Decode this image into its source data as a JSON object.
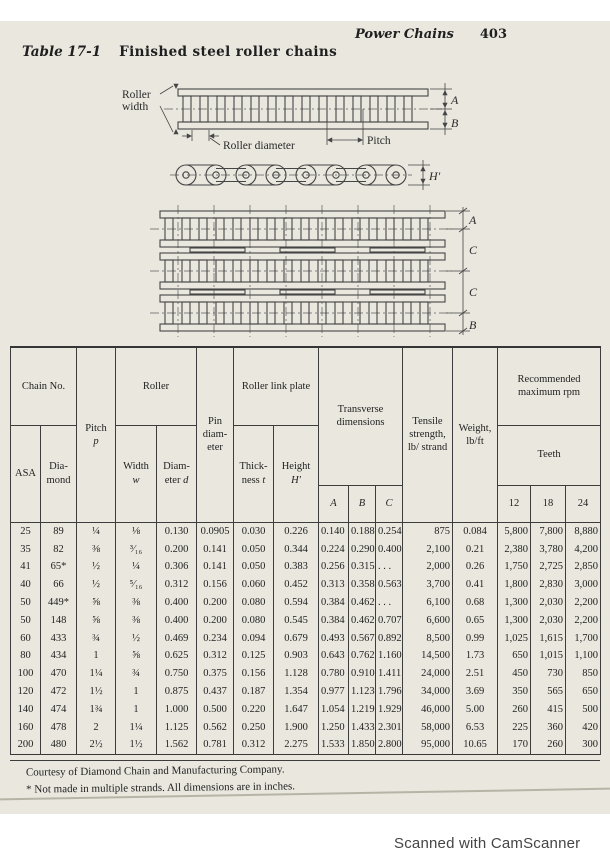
{
  "page": {
    "running_header": "Power Chains",
    "page_number": "403",
    "title_label": "Table 17-1",
    "title": "Finished steel roller chains",
    "footnote1": "Courtesy of Diamond Chain and Manufacturing Company.",
    "footnote2": "* Not made in multiple strands. All dimensions are in inches.",
    "scan_credit": "Scanned with CamScanner"
  },
  "diagram1": {
    "label_roller_width_line1": "Roller",
    "label_roller_width_line2": "width",
    "label_roller_diameter": "Roller diameter",
    "label_pitch": "Pitch",
    "dim_a": "A",
    "dim_b": "B",
    "dim_h": "H′"
  },
  "diagram2": {
    "dim_a": "A",
    "dim_c1": "C",
    "dim_c2": "C",
    "dim_b": "B"
  },
  "table": {
    "headers": {
      "chain_no": "Chain No.",
      "asa": "ASA",
      "diamond": "Dia-mond",
      "pitch_label": "Pitch",
      "pitch_var": "p",
      "roller": "Roller",
      "width_label": "Width",
      "width_var": "w",
      "diameter_label": "Diam-eter",
      "diameter_var": "d",
      "pin": "Pin diam-eter",
      "link_plate": "Roller link plate",
      "thickness_label": "Thick-ness",
      "thickness_var": "t",
      "height_label": "Height",
      "height_var": "H′",
      "transverse": "Transverse dimensions",
      "dim_a": "A",
      "dim_b": "B",
      "dim_c": "C",
      "tensile": "Tensile strength, lb/ strand",
      "weight": "Weight, lb/ft",
      "rpm": "Recommended maximum rpm",
      "teeth": "Teeth",
      "teeth_12": "12",
      "teeth_18": "18",
      "teeth_24": "24"
    },
    "rows": [
      [
        "25",
        "89",
        "¼",
        "⅛",
        "0.130",
        "0.0905",
        "0.030",
        "0.226",
        "0.140",
        "0.188",
        "0.254",
        "875",
        "0.084",
        "5,800",
        "7,800",
        "8,880"
      ],
      [
        "35",
        "82",
        "⅜",
        "³⁄₁₆",
        "0.200",
        "0.141",
        "0.050",
        "0.344",
        "0.224",
        "0.290",
        "0.400",
        "2,100",
        "0.21",
        "2,380",
        "3,780",
        "4,200"
      ],
      [
        "41",
        "65*",
        "½",
        "¼",
        "0.306",
        "0.141",
        "0.050",
        "0.383",
        "0.256",
        "0.315",
        ". . .",
        "2,000",
        "0.26",
        "1,750",
        "2,725",
        "2,850"
      ],
      [
        "40",
        "66",
        "½",
        "⁵⁄₁₆",
        "0.312",
        "0.156",
        "0.060",
        "0.452",
        "0.313",
        "0.358",
        "0.563",
        "3,700",
        "0.41",
        "1,800",
        "2,830",
        "3,000"
      ],
      [
        "50",
        "449*",
        "⅝",
        "⅜",
        "0.400",
        "0.200",
        "0.080",
        "0.594",
        "0.384",
        "0.462",
        ". . .",
        "6,100",
        "0.68",
        "1,300",
        "2,030",
        "2,200"
      ],
      [
        "50",
        "148",
        "⅝",
        "⅜",
        "0.400",
        "0.200",
        "0.080",
        "0.545",
        "0.384",
        "0.462",
        "0.707",
        "6,600",
        "0.65",
        "1,300",
        "2,030",
        "2,200"
      ],
      [
        "60",
        "433",
        "¾",
        "½",
        "0.469",
        "0.234",
        "0.094",
        "0.679",
        "0.493",
        "0.567",
        "0.892",
        "8,500",
        "0.99",
        "1,025",
        "1,615",
        "1,700"
      ],
      [
        "80",
        "434",
        "1",
        "⅝",
        "0.625",
        "0.312",
        "0.125",
        "0.903",
        "0.643",
        "0.762",
        "1.160",
        "14,500",
        "1.73",
        "650",
        "1,015",
        "1,100"
      ],
      [
        "100",
        "470",
        "1¼",
        "¾",
        "0.750",
        "0.375",
        "0.156",
        "1.128",
        "0.780",
        "0.910",
        "1.411",
        "24,000",
        "2.51",
        "450",
        "730",
        "850"
      ],
      [
        "120",
        "472",
        "1½",
        "1",
        "0.875",
        "0.437",
        "0.187",
        "1.354",
        "0.977",
        "1.123",
        "1.796",
        "34,000",
        "3.69",
        "350",
        "565",
        "650"
      ],
      [
        "140",
        "474",
        "1¾",
        "1",
        "1.000",
        "0.500",
        "0.220",
        "1.647",
        "1.054",
        "1.219",
        "1.929",
        "46,000",
        "5.00",
        "260",
        "415",
        "500"
      ],
      [
        "160",
        "478",
        "2",
        "1¼",
        "1.125",
        "0.562",
        "0.250",
        "1.900",
        "1.250",
        "1.433",
        "2.301",
        "58,000",
        "6.53",
        "225",
        "360",
        "420"
      ],
      [
        "200",
        "480",
        "2½",
        "1½",
        "1.562",
        "0.781",
        "0.312",
        "2.275",
        "1.533",
        "1.850",
        "2.800",
        "95,000",
        "10.65",
        "170",
        "260",
        "300"
      ]
    ]
  }
}
